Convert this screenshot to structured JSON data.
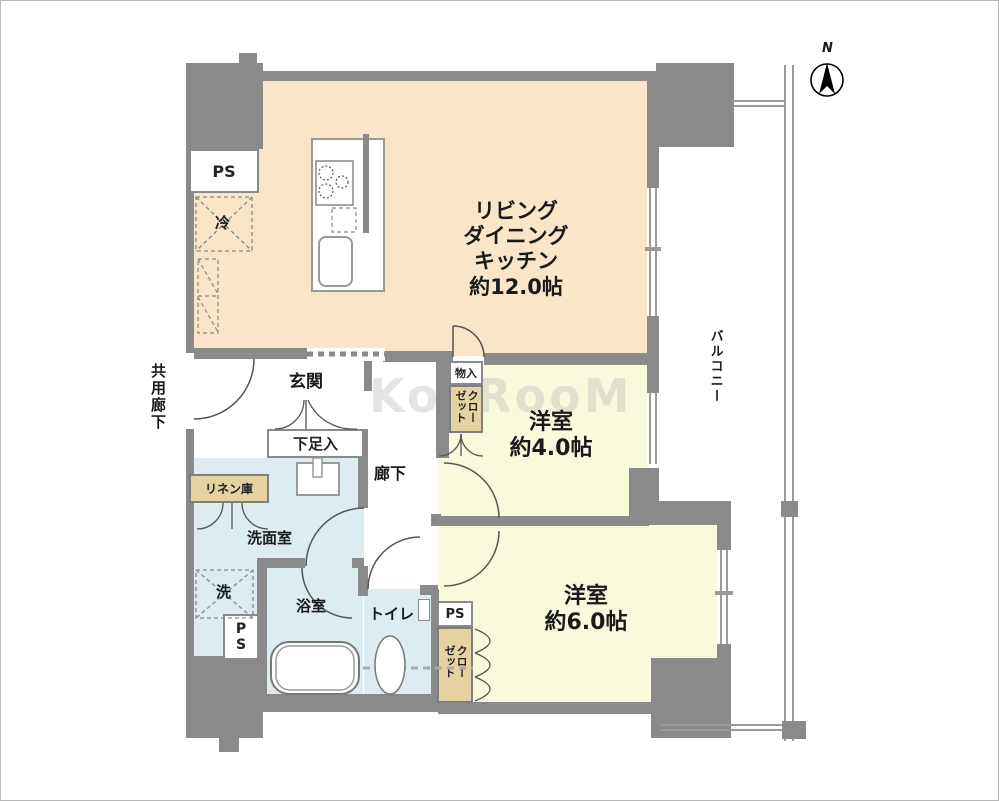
{
  "compass": {
    "label": "N"
  },
  "watermark": {
    "text": "KooRooM"
  },
  "colors": {
    "wall": "#8a8a8a",
    "ldk_floor": "#fbe5c8",
    "bedroom_floor": "#f9f9dc",
    "wet_area_floor": "#dcecf0",
    "closet_fill": "#e6d1a2"
  },
  "rooms": {
    "ldk": {
      "line1": "リビング",
      "line2": "ダイニング",
      "line3": "キッチン",
      "size": "約12.0帖"
    },
    "bedroom4": {
      "name": "洋室",
      "size": "約4.0帖"
    },
    "bedroom6": {
      "name": "洋室",
      "size": "約6.0帖"
    },
    "entrance": {
      "name": "玄関"
    },
    "hallway": {
      "name": "廊下"
    },
    "washroom": {
      "name": "洗面室"
    },
    "bathroom": {
      "name": "浴室"
    },
    "toilet": {
      "name": "トイレ"
    },
    "common_corridor": {
      "name": "共用廊下"
    },
    "balcony": {
      "name": "バルコニー"
    }
  },
  "labels": {
    "shoe_cabinet": "下足入",
    "linen_closet": "リネン庫",
    "storage": "物入",
    "closet_upper": "クローゼット",
    "closet_lower": "クローゼット",
    "refrigerator": "冷",
    "washer": "洗",
    "ps_top": "PS",
    "ps_left": "PS",
    "ps_bottom": "PS"
  }
}
